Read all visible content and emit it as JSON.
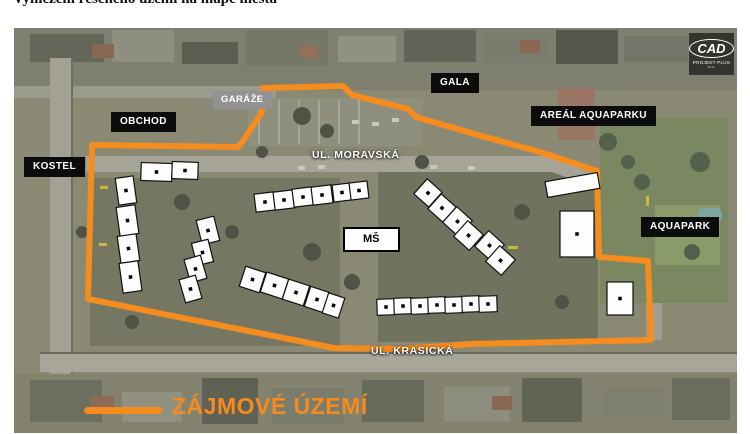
{
  "page": {
    "title": "Vymezení řešeného území na mapě města"
  },
  "colors": {
    "boundary_orange": "#F68B1E",
    "label_black_bg": "#0c0c0c",
    "label_gray_bg": "#929292"
  },
  "map": {
    "labels": {
      "obchod": "OBCHOD",
      "garaze": "GARÁŽE",
      "gala": "GALA",
      "areal_aquaparku": "AREÁL AQUAPARKU",
      "kostel": "KOSTEL",
      "ul_moravska": "UL. MORAVSKÁ",
      "ms": "MŠ",
      "aquapark": "AQUAPARK",
      "ul_krasicka": "UL. KRASICKÁ"
    },
    "legend": {
      "label": "ZÁJMOVÉ ÚZEMÍ"
    },
    "logo": {
      "text": "CAD",
      "subtext": "PROJEKT PLUS",
      "subsubtext": "s.r.o."
    },
    "boundary_points": [
      [
        92,
        145
      ],
      [
        170,
        146
      ],
      [
        238,
        147
      ],
      [
        243,
        141
      ],
      [
        262,
        112
      ],
      [
        263,
        88
      ],
      [
        343,
        86
      ],
      [
        352,
        95
      ],
      [
        408,
        109
      ],
      [
        416,
        117
      ],
      [
        478,
        135
      ],
      [
        540,
        152
      ],
      [
        597,
        171
      ],
      [
        599,
        257
      ],
      [
        648,
        261
      ],
      [
        651,
        340
      ],
      [
        560,
        342
      ],
      [
        470,
        344
      ],
      [
        400,
        349
      ],
      [
        334,
        348
      ],
      [
        88,
        299
      ]
    ],
    "buildings": [
      {
        "x": 117,
        "y": 177,
        "w": 18,
        "h": 27,
        "r": -8,
        "dot": true
      },
      {
        "x": 118,
        "y": 206,
        "w": 19,
        "h": 29,
        "r": -8,
        "dot": true
      },
      {
        "x": 119,
        "y": 235,
        "w": 19,
        "h": 27,
        "r": -8,
        "dot": true
      },
      {
        "x": 121,
        "y": 262,
        "w": 19,
        "h": 30,
        "r": -8,
        "dot": true
      },
      {
        "x": 141,
        "y": 163,
        "w": 31,
        "h": 18,
        "r": 2,
        "dot": true
      },
      {
        "x": 172,
        "y": 162,
        "w": 26,
        "h": 17,
        "r": 2,
        "dot": true
      },
      {
        "x": 199,
        "y": 218,
        "w": 18,
        "h": 25,
        "r": -14,
        "dot": true
      },
      {
        "x": 194,
        "y": 241,
        "w": 17,
        "h": 23,
        "r": -14,
        "dot": true
      },
      {
        "x": 187,
        "y": 257,
        "w": 17,
        "h": 24,
        "r": -16,
        "dot": true
      },
      {
        "x": 182,
        "y": 277,
        "w": 17,
        "h": 24,
        "r": -16,
        "dot": true
      },
      {
        "x": 255,
        "y": 193,
        "w": 20,
        "h": 18,
        "r": -7,
        "dot": true
      },
      {
        "x": 274,
        "y": 191,
        "w": 20,
        "h": 18,
        "r": -7,
        "dot": true
      },
      {
        "x": 293,
        "y": 188,
        "w": 20,
        "h": 18,
        "r": -7,
        "dot": true
      },
      {
        "x": 312,
        "y": 186,
        "w": 20,
        "h": 18,
        "r": -7,
        "dot": true
      },
      {
        "x": 333,
        "y": 184,
        "w": 18,
        "h": 17,
        "r": -7,
        "dot": true
      },
      {
        "x": 350,
        "y": 182,
        "w": 18,
        "h": 17,
        "r": -7,
        "dot": true
      },
      {
        "x": 242,
        "y": 269,
        "w": 21,
        "h": 21,
        "r": 18,
        "dot": true
      },
      {
        "x": 263,
        "y": 275,
        "w": 23,
        "h": 21,
        "r": 18,
        "dot": true
      },
      {
        "x": 285,
        "y": 282,
        "w": 22,
        "h": 21,
        "r": 18,
        "dot": true
      },
      {
        "x": 307,
        "y": 289,
        "w": 20,
        "h": 21,
        "r": 18,
        "dot": true
      },
      {
        "x": 325,
        "y": 295,
        "w": 17,
        "h": 21,
        "r": 18,
        "dot": true
      },
      {
        "x": 418,
        "y": 183,
        "w": 20,
        "h": 20,
        "r": 42,
        "dot": true
      },
      {
        "x": 432,
        "y": 198,
        "w": 20,
        "h": 20,
        "r": 42,
        "dot": true
      },
      {
        "x": 447,
        "y": 211,
        "w": 21,
        "h": 21,
        "r": 42,
        "dot": true
      },
      {
        "x": 458,
        "y": 225,
        "w": 21,
        "h": 21,
        "r": 42,
        "dot": true
      },
      {
        "x": 479,
        "y": 235,
        "w": 21,
        "h": 21,
        "r": 42,
        "dot": true
      },
      {
        "x": 490,
        "y": 250,
        "w": 21,
        "h": 21,
        "r": 42,
        "dot": true
      },
      {
        "x": 377,
        "y": 299,
        "w": 18,
        "h": 16,
        "r": -2,
        "dot": true
      },
      {
        "x": 394,
        "y": 298,
        "w": 18,
        "h": 16,
        "r": -2,
        "dot": true
      },
      {
        "x": 411,
        "y": 298,
        "w": 18,
        "h": 16,
        "r": -2,
        "dot": true
      },
      {
        "x": 428,
        "y": 297,
        "w": 18,
        "h": 16,
        "r": -2,
        "dot": true
      },
      {
        "x": 445,
        "y": 297,
        "w": 18,
        "h": 16,
        "r": -2,
        "dot": true
      },
      {
        "x": 462,
        "y": 296,
        "w": 18,
        "h": 16,
        "r": -2,
        "dot": true
      },
      {
        "x": 479,
        "y": 296,
        "w": 18,
        "h": 16,
        "r": -2,
        "dot": true
      },
      {
        "x": 546,
        "y": 177,
        "w": 53,
        "h": 16,
        "r": -10,
        "dot": false
      },
      {
        "x": 560,
        "y": 211,
        "w": 34,
        "h": 46,
        "r": 0,
        "dot": true
      },
      {
        "x": 607,
        "y": 282,
        "w": 26,
        "h": 33,
        "r": 0,
        "dot": true
      }
    ]
  }
}
